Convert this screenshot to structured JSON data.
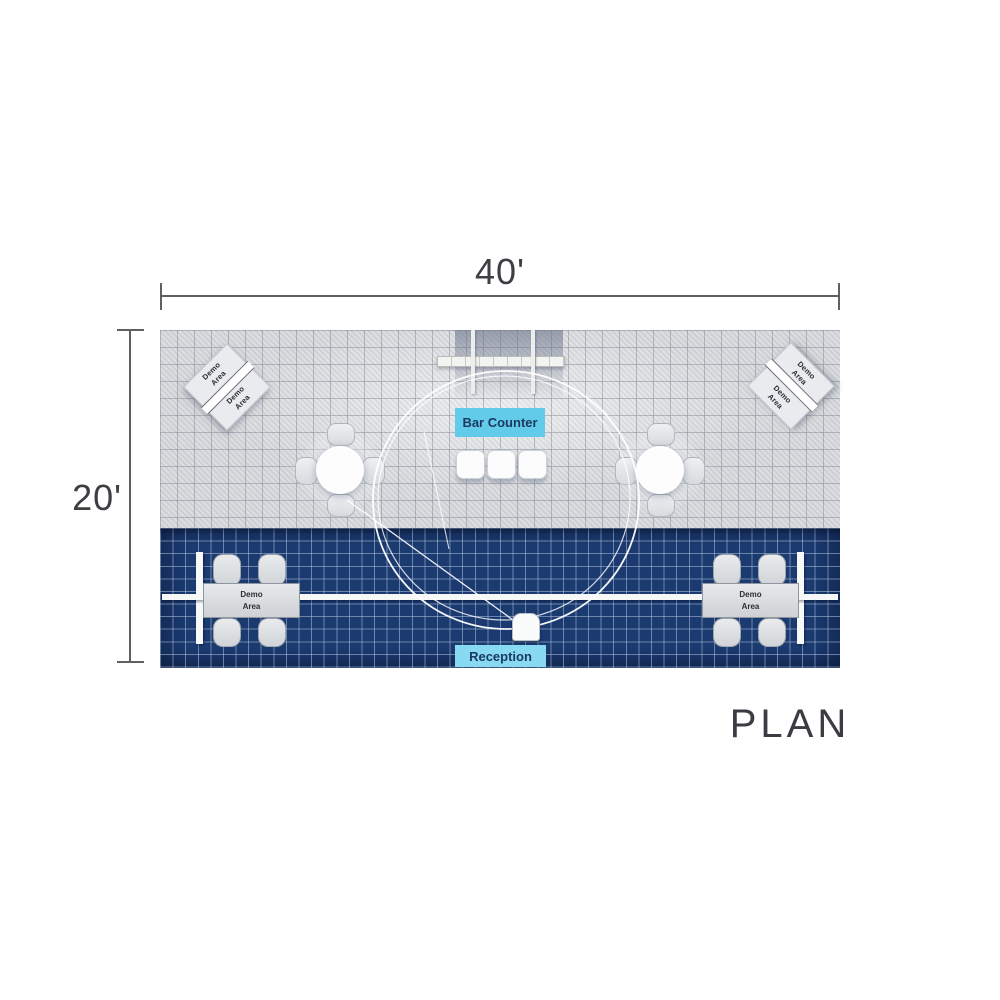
{
  "figure": {
    "width_dim": "40'",
    "height_dim": "20'",
    "caption": "PLAN"
  },
  "plan": {
    "bar_counter_label": "Bar Counter",
    "reception_label": "Reception",
    "demo_word1": "Demo",
    "demo_word2": "Area"
  },
  "colors": {
    "bar_label_cyan": "#62cbe9",
    "reception_label_cyan": "#87daf1",
    "label_text_navy": "#1c3a61",
    "carpet_navy": "#1a3a70",
    "floor_gray": "#d6d8db",
    "dimension_text_gray": "#3e3e45",
    "structure_white": "#f6f8f7"
  }
}
